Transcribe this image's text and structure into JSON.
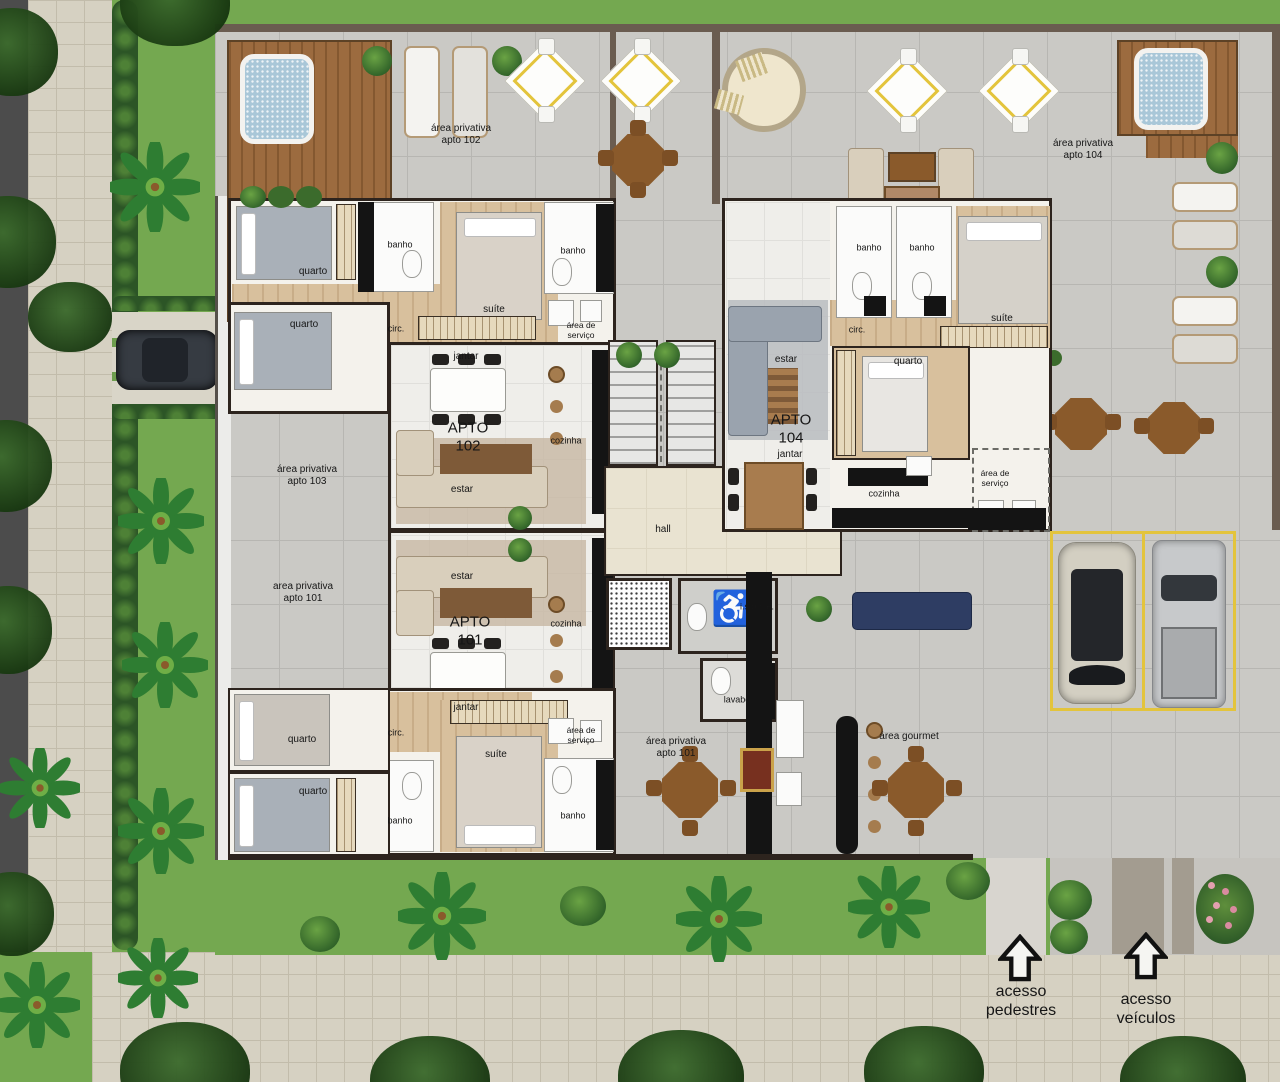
{
  "meta": {
    "kind": "architectural-floor-plan",
    "language": "pt-BR"
  },
  "palette": {
    "grass": "#74a850",
    "terrace_tile": "#cac9c5",
    "deck_wood": "#9c6b3f",
    "wall": "#2d241e",
    "spa_water": "#a9c7d8",
    "parking_accent": "#e3c43c",
    "hall_floor": "#e9e3d1",
    "counter_granite": "#141414",
    "label_text": "#161616"
  },
  "icons": {
    "wheelchair": "♿"
  },
  "labels": [
    {
      "id": "area-apto-102",
      "text": "área privativa\napto 102",
      "x": 461,
      "y": 135,
      "size": 10
    },
    {
      "id": "area-apto-104",
      "text": "área privativa\napto 104",
      "x": 1083,
      "y": 150,
      "size": 10
    },
    {
      "id": "area-apto-103",
      "text": "área privativa\napto 103",
      "x": 307,
      "y": 476,
      "size": 10
    },
    {
      "id": "area-apto-101-west",
      "text": "area privativa\napto 101",
      "x": 303,
      "y": 593,
      "size": 10
    },
    {
      "id": "area-apto-101-south",
      "text": "área privativa\napto 101",
      "x": 676,
      "y": 748,
      "size": 10
    },
    {
      "id": "area-gourmet",
      "text": "área gourmet",
      "x": 909,
      "y": 737,
      "size": 10
    },
    {
      "id": "apto-102",
      "text": "APTO\n102",
      "x": 468,
      "y": 437,
      "size": 15
    },
    {
      "id": "apto-101",
      "text": "APTO\n101",
      "x": 470,
      "y": 631,
      "size": 15
    },
    {
      "id": "apto-104",
      "text": "APTO\n104",
      "x": 791,
      "y": 429,
      "size": 15
    },
    {
      "id": "jantar-102",
      "text": "jantar",
      "x": 466,
      "y": 357,
      "size": 10
    },
    {
      "id": "jantar-101",
      "text": "jantar",
      "x": 466,
      "y": 708,
      "size": 10
    },
    {
      "id": "jantar-104",
      "text": "jantar",
      "x": 790,
      "y": 455,
      "size": 10
    },
    {
      "id": "estar-102",
      "text": "estar",
      "x": 462,
      "y": 490,
      "size": 10
    },
    {
      "id": "estar-101",
      "text": "estar",
      "x": 462,
      "y": 577,
      "size": 10
    },
    {
      "id": "estar-104",
      "text": "estar",
      "x": 786,
      "y": 360,
      "size": 10
    },
    {
      "id": "cozinha-102",
      "text": "cozinha",
      "x": 566,
      "y": 441,
      "size": 9
    },
    {
      "id": "cozinha-101",
      "text": "cozinha",
      "x": 566,
      "y": 624,
      "size": 9
    },
    {
      "id": "cozinha-104",
      "text": "cozinha",
      "x": 884,
      "y": 494,
      "size": 9
    },
    {
      "id": "quarto-102a",
      "text": "quarto",
      "x": 313,
      "y": 272,
      "size": 10
    },
    {
      "id": "quarto-103",
      "text": "quarto",
      "x": 304,
      "y": 325,
      "size": 10
    },
    {
      "id": "quarto-101a",
      "text": "quarto",
      "x": 302,
      "y": 740,
      "size": 10
    },
    {
      "id": "quarto-101b",
      "text": "quarto",
      "x": 313,
      "y": 792,
      "size": 10
    },
    {
      "id": "quarto-104",
      "text": "quarto",
      "x": 908,
      "y": 362,
      "size": 10
    },
    {
      "id": "suite-102",
      "text": "suíte",
      "x": 494,
      "y": 310,
      "size": 10
    },
    {
      "id": "suite-101",
      "text": "suíte",
      "x": 496,
      "y": 755,
      "size": 10
    },
    {
      "id": "suite-104",
      "text": "suíte",
      "x": 1002,
      "y": 319,
      "size": 10
    },
    {
      "id": "banho-102a",
      "text": "banho",
      "x": 400,
      "y": 245,
      "size": 9
    },
    {
      "id": "banho-102b",
      "text": "banho",
      "x": 573,
      "y": 251,
      "size": 9
    },
    {
      "id": "banho-101a",
      "text": "banho",
      "x": 400,
      "y": 821,
      "size": 9
    },
    {
      "id": "banho-101b",
      "text": "banho",
      "x": 573,
      "y": 816,
      "size": 9
    },
    {
      "id": "banho-104a",
      "text": "banho",
      "x": 869,
      "y": 248,
      "size": 9
    },
    {
      "id": "banho-104b",
      "text": "banho",
      "x": 922,
      "y": 248,
      "size": 9
    },
    {
      "id": "circ-102",
      "text": "circ.",
      "x": 396,
      "y": 329,
      "size": 9
    },
    {
      "id": "circ-101",
      "text": "circ.",
      "x": 396,
      "y": 733,
      "size": 9
    },
    {
      "id": "circ-104",
      "text": "circ.",
      "x": 857,
      "y": 330,
      "size": 9
    },
    {
      "id": "servico-102",
      "text": "área de\nserviço",
      "x": 581,
      "y": 330,
      "size": 8.5
    },
    {
      "id": "servico-101",
      "text": "área de\nserviço",
      "x": 581,
      "y": 735,
      "size": 8.5
    },
    {
      "id": "servico-104",
      "text": "área de\nserviço",
      "x": 995,
      "y": 478,
      "size": 8.5
    },
    {
      "id": "hall",
      "text": "hall",
      "x": 663,
      "y": 530,
      "size": 10
    },
    {
      "id": "ispne",
      "text": "i.s.p.n.e.",
      "x": 757,
      "y": 607,
      "size": 9
    },
    {
      "id": "lavabo",
      "text": "lavabo",
      "x": 737,
      "y": 700,
      "size": 9
    },
    {
      "id": "acesso-pedestres",
      "text": "acesso\npedestres",
      "x": 1021,
      "y": 1002,
      "size": 16
    },
    {
      "id": "acesso-veiculos",
      "text": "acesso\nveículos",
      "x": 1146,
      "y": 1010,
      "size": 16
    }
  ]
}
